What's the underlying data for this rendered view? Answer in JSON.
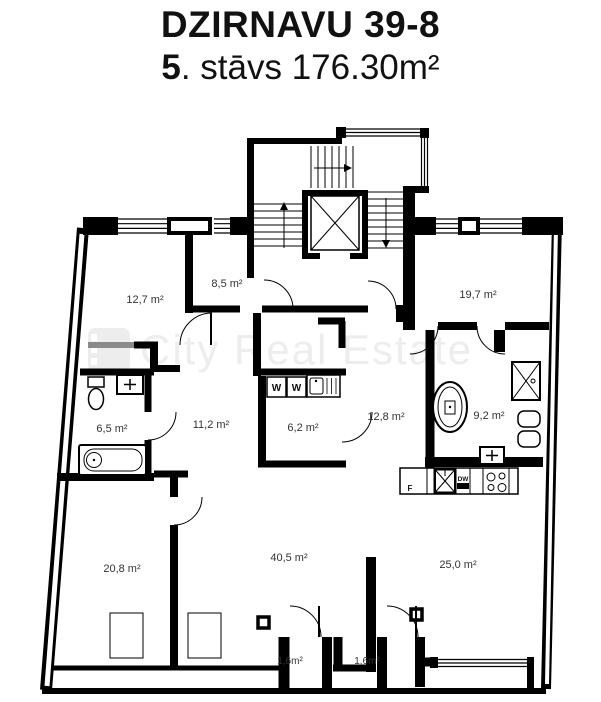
{
  "header": {
    "title": "DZIRNAVU 39-8",
    "floor_number": "5",
    "subtitle_rest": ". stāvs 176.30m²"
  },
  "watermark": {
    "text": "City Real Estate",
    "logo": "film-strip-logo"
  },
  "plan": {
    "rooms": [
      {
        "name": "room-12-7",
        "label": "12,7 m²"
      },
      {
        "name": "hall-8-5",
        "label": "8,5 m²"
      },
      {
        "name": "room-19-7",
        "label": "19,7 m²"
      },
      {
        "name": "bathroom-6-5",
        "label": "6,5 m²"
      },
      {
        "name": "hall-11-2",
        "label": "11,2 m²"
      },
      {
        "name": "laundry-6-2",
        "label": "6,2 m²"
      },
      {
        "name": "corridor-12-8",
        "label": "12,8 m²"
      },
      {
        "name": "bathroom-9-2",
        "label": "9,2 m²"
      },
      {
        "name": "room-20-8",
        "label": "20,8 m²"
      },
      {
        "name": "living-40-5",
        "label": "40,5 m²"
      },
      {
        "name": "kitchen-25-0",
        "label": "25,0 m²"
      },
      {
        "name": "balcony-1",
        "label": "1,6m²"
      },
      {
        "name": "balcony-2",
        "label": "1,6m²"
      }
    ],
    "appliances": [
      {
        "name": "washer-1",
        "label": "W"
      },
      {
        "name": "washer-2",
        "label": "W"
      },
      {
        "name": "fridge",
        "label": "F"
      },
      {
        "name": "dishwasher",
        "label": "DW"
      }
    ],
    "fixtures": [
      "elevator",
      "staircase",
      "toilet",
      "washbasin",
      "bathtub",
      "freestanding-bathtub",
      "shower",
      "kitchen-counter",
      "stove-hob",
      "kitchen-sink",
      "laundry-sink",
      "radiators",
      "wardrobe",
      "windows",
      "door-arcs"
    ]
  },
  "colors": {
    "walls": "#000000",
    "gray_wall": "#8a8a8a",
    "watermark": "#ededed",
    "background": "#ffffff"
  }
}
